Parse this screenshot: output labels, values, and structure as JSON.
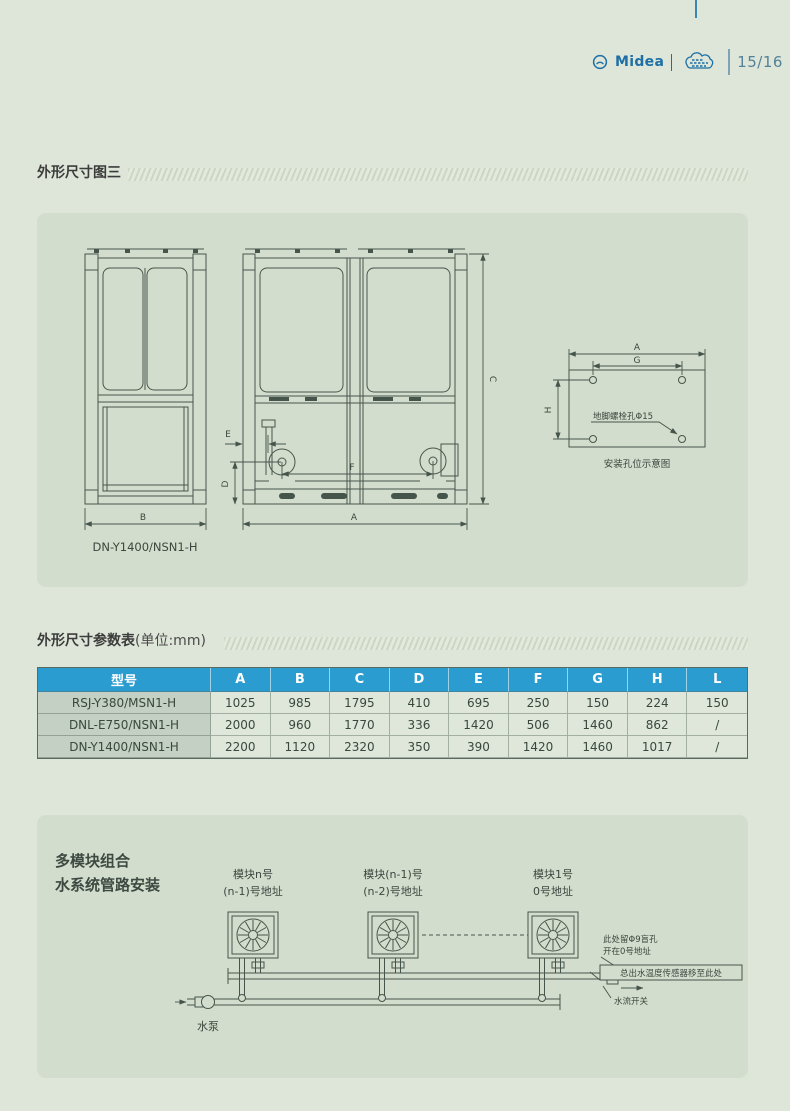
{
  "page": {
    "brand": "Midea",
    "page_number": "15/16"
  },
  "section_dim_figure": {
    "title": "外形尺寸图三",
    "model_label": "DN-Y1400/NSN1-H",
    "dims": {
      "A": "A",
      "B": "B",
      "C": "C",
      "D": "D",
      "E": "E",
      "F": "F",
      "G": "G",
      "H": "H"
    },
    "hole_diagram": {
      "note": "地脚螺栓孔Φ15",
      "caption": "安装孔位示意图"
    }
  },
  "section_dim_table": {
    "title": "外形尺寸参数表",
    "unit": "(单位:mm)",
    "headers": [
      "型号",
      "A",
      "B",
      "C",
      "D",
      "E",
      "F",
      "G",
      "H",
      "L"
    ],
    "rows": [
      {
        "model": "RSJ-Y380/MSN1-H",
        "values": [
          "1025",
          "985",
          "1795",
          "410",
          "695",
          "250",
          "150",
          "224",
          "150"
        ]
      },
      {
        "model": "DNL-E750/NSN1-H",
        "values": [
          "2000",
          "960",
          "1770",
          "336",
          "1420",
          "506",
          "1460",
          "862",
          "/"
        ]
      },
      {
        "model": "DN-Y1400/NSN1-H",
        "values": [
          "2200",
          "1120",
          "2320",
          "350",
          "390",
          "1420",
          "1460",
          "1017",
          "/"
        ]
      }
    ]
  },
  "section_piping": {
    "title_line1": "多模块组合",
    "title_line2": "水系统管路安装",
    "modules": [
      {
        "name": "模块n号",
        "address": "(n-1)号地址"
      },
      {
        "name": "模块(n-1)号",
        "address": "(n-2)号地址"
      },
      {
        "name": "模块1号",
        "address": "0号地址"
      }
    ],
    "pump_label": "水泵",
    "notes": {
      "hole_line1": "此处留Φ9盲孔",
      "hole_line2": "开在0号地址",
      "sensor": "总出水温度传感器移至此处",
      "flow_switch": "水流开关"
    }
  },
  "colors": {
    "page_bg": "#dde6d8",
    "panel_bg": "#d3ddcd",
    "table_header_bg": "#2b9cd0",
    "brand_blue": "#1d6fa5",
    "line_color": "#46554b"
  }
}
